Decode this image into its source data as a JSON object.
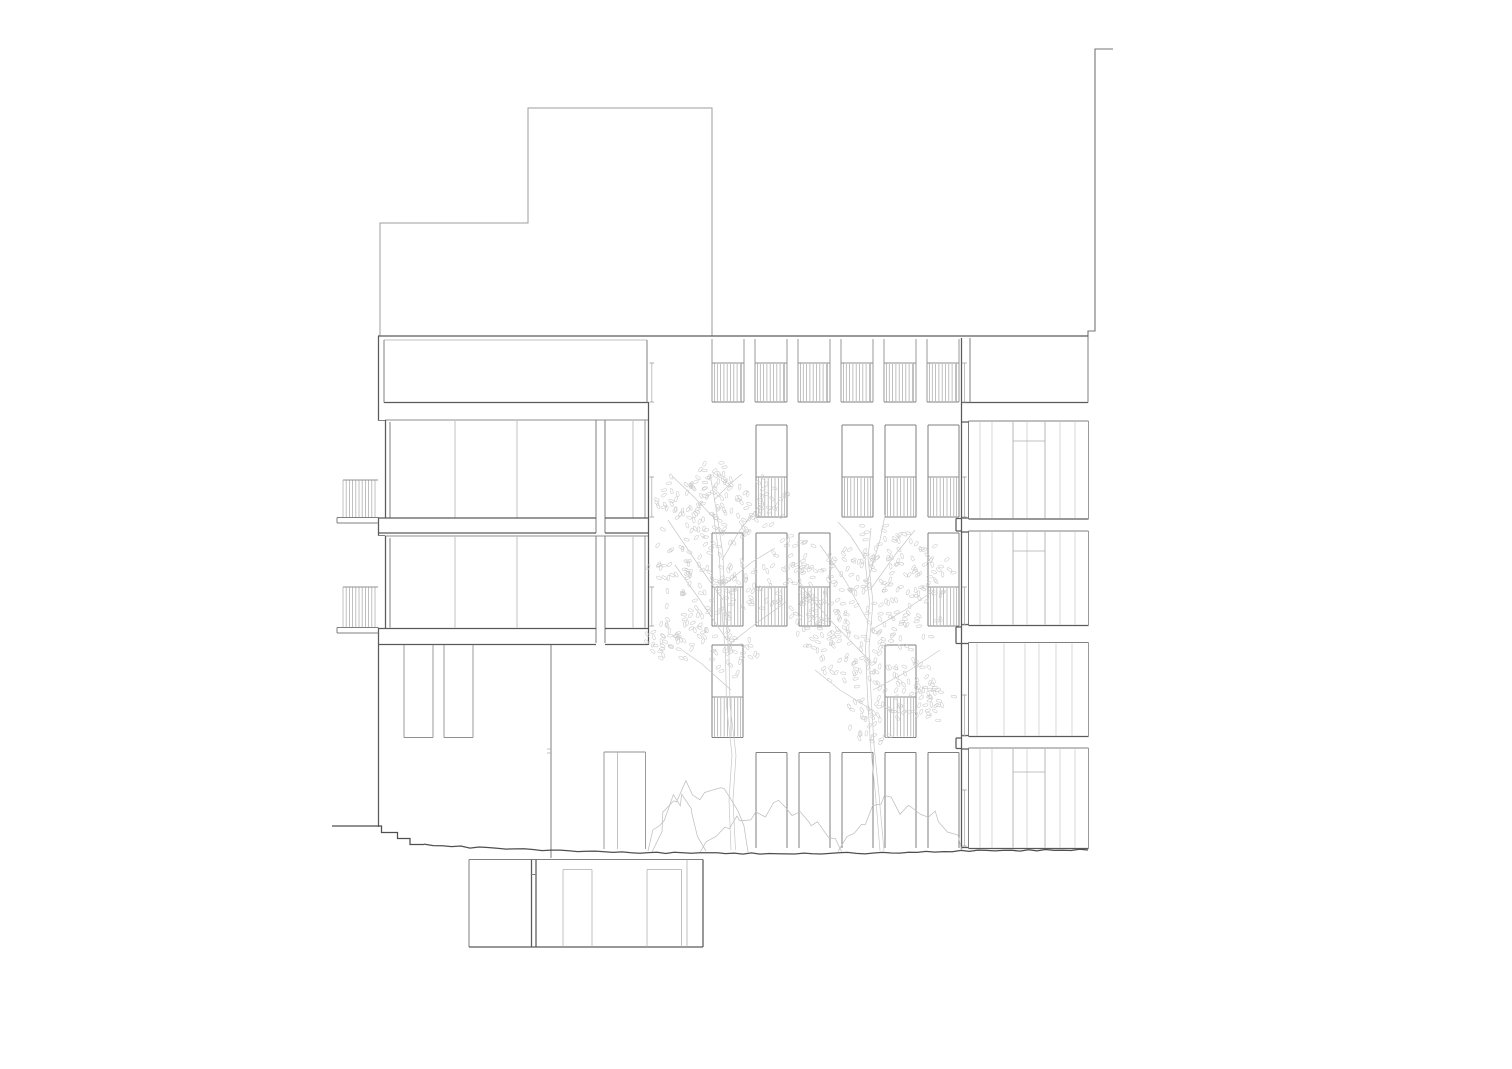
{
  "document": {
    "kind": "architectural-elevation-drawing",
    "visible_text": [],
    "background_color": "#ffffff"
  },
  "canvas": {
    "width": 1512,
    "height": 1069
  },
  "strokes": {
    "heavy": {
      "color": "#5a5a5a",
      "width": 1.25
    },
    "med": {
      "color": "#7f7f7f",
      "width": 1.0
    },
    "med2": {
      "color": "#8f8f8f",
      "width": 0.9
    },
    "light": {
      "color": "#acacac",
      "width": 0.75
    },
    "faint": {
      "color": "#c7c7c7",
      "width": 0.7
    },
    "roof": {
      "color": "#9e9e9e",
      "width": 1.0
    },
    "neighbor": {
      "color": "#757575",
      "width": 1.1
    },
    "ground": {
      "color": "#4f4f4f",
      "width": 1.25
    },
    "leaf": {
      "color": "#c9c9c9",
      "width": 0.55
    },
    "bush": {
      "color": "#bfbfbf",
      "width": 0.75
    },
    "serif": {
      "color": "#9a9a9a",
      "width": 0.8
    }
  },
  "context": {
    "roof_profile": [
      [
        380,
        336
      ],
      [
        380,
        223
      ],
      [
        528,
        223
      ],
      [
        528,
        108
      ],
      [
        712,
        108
      ],
      [
        712,
        336
      ]
    ],
    "neighbor_profile": [
      [
        1113,
        49
      ],
      [
        1095,
        49
      ],
      [
        1095,
        331
      ],
      [
        1088,
        331
      ],
      [
        1088,
        338
      ]
    ]
  },
  "parapet": {
    "y": 336,
    "x0": 378,
    "x1": 1088
  },
  "attic": {
    "left_opening": {
      "x0": 384,
      "x1": 647,
      "top": 340,
      "bottom": 402.5
    },
    "right_opening": {
      "x0": 970,
      "x1": 1088,
      "top": 338,
      "bottom": 402.5,
      "bottom_x0": 961.5
    },
    "bays": {
      "xs": [
        712,
        755,
        798,
        841,
        884,
        927
      ],
      "width": 32,
      "top": 339,
      "rail": 363,
      "bottom": 402,
      "hatch_spacing": 3.3
    }
  },
  "left_wing": {
    "wall_x": 378.5,
    "wall_segments": [
      [
        336,
        421
      ],
      [
        518,
        536
      ],
      [
        628,
        827
      ]
    ],
    "wall_steps": [
      [
        378,
        420.5,
        385,
        420.5
      ],
      [
        378,
        535.5,
        385,
        535.5
      ]
    ],
    "bands": [
      {
        "top": 420,
        "bottom": 517.5,
        "jamb": [
          385.5,
          390
        ],
        "glass": [
          392,
          595
        ],
        "mullions": [
          455,
          517
        ],
        "narrow": {
          "x0": 605,
          "x1": 645,
          "mullion": 633
        }
      },
      {
        "top": 536,
        "bottom": 627.5,
        "jamb": [
          385.5,
          390
        ],
        "glass": [
          392,
          595
        ],
        "mullions": [
          455,
          517
        ],
        "narrow": {
          "x0": 605,
          "x1": 645,
          "mullion": 633
        }
      }
    ],
    "pier": {
      "x0": 596,
      "x1": 605
    },
    "slab_bands": [
      {
        "y0": 518,
        "y1": 533
      },
      {
        "y0": 628.5,
        "y1": 644.5
      }
    ],
    "slab_span": {
      "x0": 378,
      "gap0": 596,
      "gap1": 605,
      "x1": 648
    },
    "corner_x": 648.5,
    "corner_y0": 402,
    "corner_y1": 645,
    "balconies": [
      {
        "x0": 343,
        "x1": 378,
        "top": 480,
        "bottom": 517,
        "slab": [
          337,
          517.5,
          378.5,
          523
        ],
        "hatch_spacing": 3.2
      },
      {
        "x0": 343,
        "x1": 378,
        "top": 587,
        "bottom": 627,
        "slab": [
          337,
          627.5,
          378.5,
          633
        ],
        "hatch_spacing": 3.2
      }
    ],
    "setback": {
      "hanging_windows": [
        [
          404,
          645,
          433,
          737.5
        ],
        [
          444,
          645,
          473,
          737.5
        ]
      ],
      "corner": {
        "x": 551,
        "y0": 645,
        "y1": 858,
        "ticks": [
          749,
          753
        ]
      },
      "door": {
        "x0": 604,
        "x1": 645.5,
        "top": 752,
        "bottom": 849,
        "mullion": 617.5
      }
    }
  },
  "courtyard": {
    "wall": {
      "x": 961.5,
      "y0": 338,
      "y1": 849
    },
    "wall_bumps": [
      [
        518.5,
        531
      ],
      [
        627,
        643.5
      ],
      [
        738,
        748.5
      ]
    ],
    "columns": [
      712,
      756,
      799,
      842,
      885,
      928
    ],
    "window_width": 31,
    "rows": [
      {
        "top": 425,
        "rail": 477,
        "bottom": 517,
        "cols": [
          1,
          3,
          4,
          5
        ]
      },
      {
        "top": 533,
        "rail": 587,
        "bottom": 626,
        "cols": [
          0,
          1,
          2,
          5
        ]
      },
      {
        "top": 645,
        "rail": 697,
        "bottom": 737.5,
        "cols": [
          0,
          4
        ]
      },
      {
        "top": 752.5,
        "rail": null,
        "bottom": 848,
        "cols": [
          1,
          2,
          3,
          4,
          5
        ]
      }
    ],
    "hatch_spacing": 3.4
  },
  "right_wing": {
    "x0": 968.5,
    "x1": 1088.5,
    "panels": [
      {
        "top": 421,
        "bottom": 519,
        "door_y": 441,
        "alt": false
      },
      {
        "top": 531,
        "bottom": 625.5,
        "door_y": 551,
        "alt": false
      },
      {
        "top": 642.5,
        "bottom": 736.5,
        "door_y": null,
        "alt": true
      },
      {
        "top": 748,
        "bottom": 848.5,
        "door_y": 772,
        "alt": false
      }
    ],
    "slats": [
      980,
      992,
      1013,
      1027,
      1045,
      1060,
      1075
    ],
    "alt_slats": [
      977,
      1004,
      1025,
      1039,
      1056,
      1072
    ],
    "door_x": [
      1013,
      1045
    ],
    "connector_x": 961.5
  },
  "downpipes": [
    {
      "x": 651.8,
      "segments": [
        [
          363,
          402
        ],
        [
          477,
          517
        ],
        [
          587,
          626
        ]
      ]
    },
    {
      "x": 964.5,
      "segments": [
        [
          363,
          402
        ],
        [
          477,
          517
        ],
        [
          587,
          625
        ],
        [
          695,
          736
        ],
        [
          790,
          846
        ]
      ]
    }
  ],
  "ground": {
    "steps": [
      [
        332,
        826
      ],
      [
        381.5,
        826
      ],
      [
        381.5,
        832.5
      ],
      [
        397.5,
        832.5
      ],
      [
        397.5,
        838.5
      ],
      [
        410,
        838.5
      ],
      [
        410,
        844.5
      ],
      [
        424,
        844.5
      ]
    ],
    "profile": [
      [
        424,
        844.5
      ],
      [
        470,
        847.5
      ],
      [
        551,
        850.5
      ],
      [
        640,
        852.5
      ],
      [
        700,
        853
      ],
      [
        760,
        853.5
      ],
      [
        830,
        853.5
      ],
      [
        900,
        852.5
      ],
      [
        961,
        851
      ],
      [
        1020,
        850.5
      ],
      [
        1088,
        850
      ]
    ],
    "jitter": 0.9,
    "segment": 9
  },
  "basement": {
    "outline": {
      "x0": 469,
      "x1": 703,
      "top": 859.5,
      "bottom": 947
    },
    "divider": {
      "x0": 531.5,
      "x1": 536,
      "notch_y": 874.5
    },
    "inner_doors": [
      [
        563,
        869.5,
        592,
        947
      ],
      [
        647,
        869.5,
        681.5,
        947
      ]
    ],
    "extra_vertical": 687
  },
  "trees": [
    {
      "trunks": [
        [
          [
            735.5,
            850
          ],
          [
            733,
            800
          ],
          [
            736,
            755
          ],
          [
            730,
            705
          ],
          [
            729,
            655
          ],
          [
            725,
            605
          ],
          [
            723,
            555
          ],
          [
            716,
            508
          ],
          [
            711,
            480
          ]
        ],
        [
          [
            731,
            850
          ],
          [
            729,
            800
          ],
          [
            732,
            755
          ],
          [
            726.5,
            705
          ],
          [
            725.5,
            655
          ],
          [
            721.5,
            605
          ],
          [
            719.5,
            558
          ],
          [
            713,
            512
          ]
        ]
      ],
      "branches": [
        [
          [
            727,
            640
          ],
          [
            700,
            600
          ],
          [
            675,
            565
          ]
        ],
        [
          [
            723,
            600
          ],
          [
            695,
            560
          ],
          [
            668,
            520
          ]
        ],
        [
          [
            722,
            560
          ],
          [
            740,
            530
          ],
          [
            760,
            505
          ]
        ],
        [
          [
            716,
            520
          ],
          [
            692,
            495
          ],
          [
            672,
            476
          ]
        ],
        [
          [
            728,
            645
          ],
          [
            758,
            622
          ],
          [
            786,
            602
          ]
        ],
        [
          [
            724,
            585
          ],
          [
            752,
            562
          ],
          [
            775,
            548
          ]
        ],
        [
          [
            731,
            690
          ],
          [
            702,
            664
          ],
          [
            682,
            650
          ]
        ],
        [
          [
            714,
            500
          ],
          [
            730,
            484
          ],
          [
            742,
            474
          ]
        ]
      ],
      "blobs": [
        [
          690,
          555,
          46
        ],
        [
          722,
          515,
          38
        ],
        [
          700,
          615,
          36
        ],
        [
          748,
          585,
          34
        ],
        [
          762,
          502,
          28
        ],
        [
          678,
          498,
          26
        ],
        [
          712,
          480,
          22
        ],
        [
          670,
          640,
          26
        ],
        [
          735,
          655,
          24
        ]
      ],
      "seed": 7
    },
    {
      "trunks": [
        [
          [
            884,
            851
          ],
          [
            879,
            795
          ],
          [
            874,
            745
          ],
          [
            871,
            695
          ],
          [
            869,
            648
          ],
          [
            873,
            602
          ],
          [
            868,
            558
          ],
          [
            871,
            528
          ]
        ],
        [
          [
            880,
            851
          ],
          [
            875.5,
            795
          ],
          [
            870.5,
            745
          ],
          [
            867.5,
            695
          ],
          [
            865.5,
            648
          ],
          [
            869.5,
            602
          ],
          [
            865,
            560
          ]
        ]
      ],
      "branches": [
        [
          [
            869,
            660
          ],
          [
            830,
            620
          ],
          [
            800,
            585
          ]
        ],
        [
          [
            867,
            620
          ],
          [
            845,
            580
          ],
          [
            820,
            545
          ]
        ],
        [
          [
            870,
            590
          ],
          [
            895,
            555
          ],
          [
            915,
            530
          ]
        ],
        [
          [
            871,
            630
          ],
          [
            905,
            610
          ],
          [
            935,
            590
          ]
        ],
        [
          [
            873,
            690
          ],
          [
            910,
            670
          ],
          [
            940,
            650
          ]
        ],
        [
          [
            868,
            580
          ],
          [
            880,
            540
          ],
          [
            885,
            515
          ]
        ],
        [
          [
            872,
            710
          ],
          [
            840,
            690
          ],
          [
            815,
            670
          ]
        ],
        [
          [
            866,
            560
          ],
          [
            850,
            535
          ],
          [
            838,
            522
          ]
        ]
      ],
      "blobs": [
        [
          845,
          588,
          44
        ],
        [
          880,
          558,
          40
        ],
        [
          905,
          618,
          40
        ],
        [
          855,
          658,
          38
        ],
        [
          900,
          682,
          34
        ],
        [
          925,
          572,
          30
        ],
        [
          820,
          628,
          30
        ],
        [
          872,
          718,
          28
        ],
        [
          932,
          700,
          24
        ],
        [
          800,
          600,
          24
        ],
        [
          795,
          555,
          22
        ]
      ],
      "seed": 13
    }
  ],
  "shrubs": [
    {
      "x0": 648,
      "x1": 706,
      "h": 55,
      "base": 851,
      "seed": 3
    },
    {
      "x0": 652,
      "x1": 748,
      "h": 84,
      "base": 852,
      "seed": 21
    },
    {
      "x0": 700,
      "x1": 842,
      "h": 52,
      "base": 852.5,
      "seed": 5
    },
    {
      "x0": 838,
      "x1": 962,
      "h": 58,
      "base": 851.5,
      "seed": 11
    }
  ]
}
